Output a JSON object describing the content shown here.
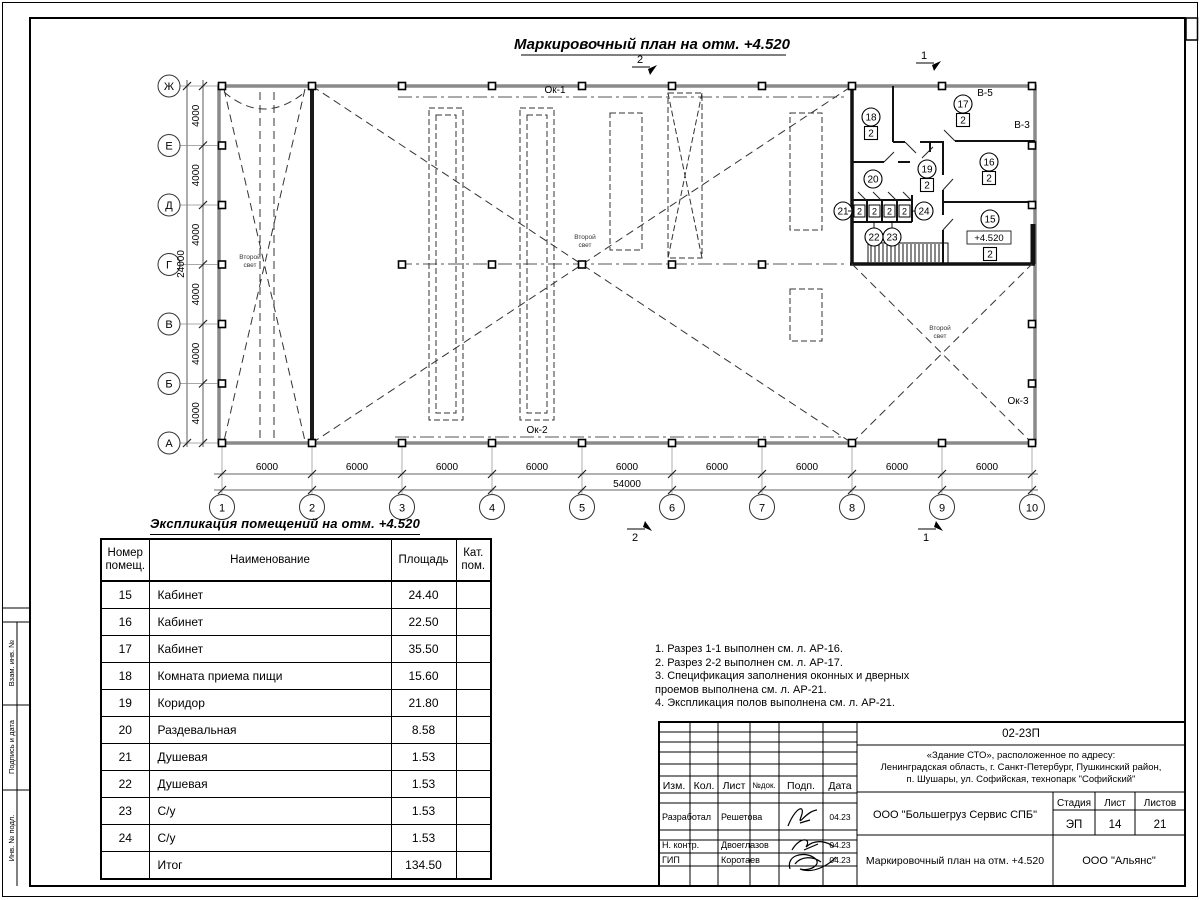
{
  "title": {
    "main": "Маркировочный план на отм. +4.520"
  },
  "plan": {
    "row_labels": [
      "Ж",
      "Е",
      "Д",
      "Г",
      "В",
      "Б",
      "А"
    ],
    "col_labels": [
      "1",
      "2",
      "3",
      "4",
      "5",
      "6",
      "7",
      "8",
      "9",
      "10"
    ],
    "row_spacing_dim": "4000",
    "row_total_dim": "24000",
    "col_spacing_dim": "6000",
    "col_total_dim": "54000",
    "room_nums": [
      "15",
      "16",
      "17",
      "18",
      "19",
      "20",
      "21",
      "22",
      "23",
      "24"
    ],
    "cat_label": "2",
    "elevation_mark": "+4.520",
    "second_light_line1": "Второй",
    "second_light_line2": "свет",
    "window_band_1": "Ок-1",
    "window_band_2": "Ок-2",
    "window_band_3": "Ок-3",
    "axis_mark_v5": "В-5",
    "axis_mark_v3": "В-3",
    "section_marks": [
      "2",
      "1",
      "2",
      "1"
    ]
  },
  "table": {
    "title": "Экспликация помещений на отм. +4.520",
    "headers": [
      "Номер помещ.",
      "Наименование",
      "Площадь",
      "Кат. пом."
    ],
    "rows": [
      [
        "15",
        "Кабинет",
        "24.40",
        ""
      ],
      [
        "16",
        "Кабинет",
        "22.50",
        ""
      ],
      [
        "17",
        "Кабинет",
        "35.50",
        ""
      ],
      [
        "18",
        "Комната приема пищи",
        "15.60",
        ""
      ],
      [
        "19",
        "Коридор",
        "21.80",
        ""
      ],
      [
        "20",
        "Раздевальная",
        "8.58",
        ""
      ],
      [
        "21",
        "Душевая",
        "1.53",
        ""
      ],
      [
        "22",
        "Душевая",
        "1.53",
        ""
      ],
      [
        "23",
        "С/у",
        "1.53",
        ""
      ],
      [
        "24",
        "С/у",
        "1.53",
        ""
      ],
      [
        "",
        "Итог",
        "134.50",
        ""
      ]
    ]
  },
  "notes": {
    "lines": [
      "1. Разрез 1-1 выполнен см. л. АР-16.",
      "2. Разрез 2-2 выполнен см. л. АР-17.",
      "3. Спецификация заполнения оконных и дверных\n    проемов выполнена см. л. АР-21.",
      "4. Экспликация полов выполнена см. л. АР-21."
    ]
  },
  "titleblock": {
    "doc_number": "02-23П",
    "address_lines": [
      "«Здание СТО», расположенное по адресу:",
      "Ленинградская область, г. Санкт-Петербург, Пушкинский район,",
      "п. Шушары, ул. Софийская, технопарк \"Софийский\""
    ],
    "cols": {
      "izm": "Изм.",
      "kol": "Кол.",
      "list": "Лист",
      "ndok": "№док.",
      "podp": "Подп.",
      "data": "Дата"
    },
    "rows": [
      {
        "role": "Разработал",
        "name": "Решетова",
        "date": "04.23"
      },
      {
        "role": "Н. контр.",
        "name": "Двоеглазов",
        "date": "04.23"
      },
      {
        "role": "ГИП",
        "name": "Коротаев",
        "date": "04.23"
      }
    ],
    "company": "ООО \"Большегруз Сервис СПБ\"",
    "stage_label": "Стадия",
    "sheet_label": "Лист",
    "sheets_label": "Листов",
    "stage": "ЭП",
    "sheet_num": "14",
    "sheets_total": "21",
    "drawing_name": "Маркировочный план на отм. +4.520",
    "org": "ООО \"Альянс\""
  },
  "side_stamp": {
    "labels": [
      "Взам. инв. №",
      "Подпись и дата",
      "Инв. № подл."
    ]
  }
}
